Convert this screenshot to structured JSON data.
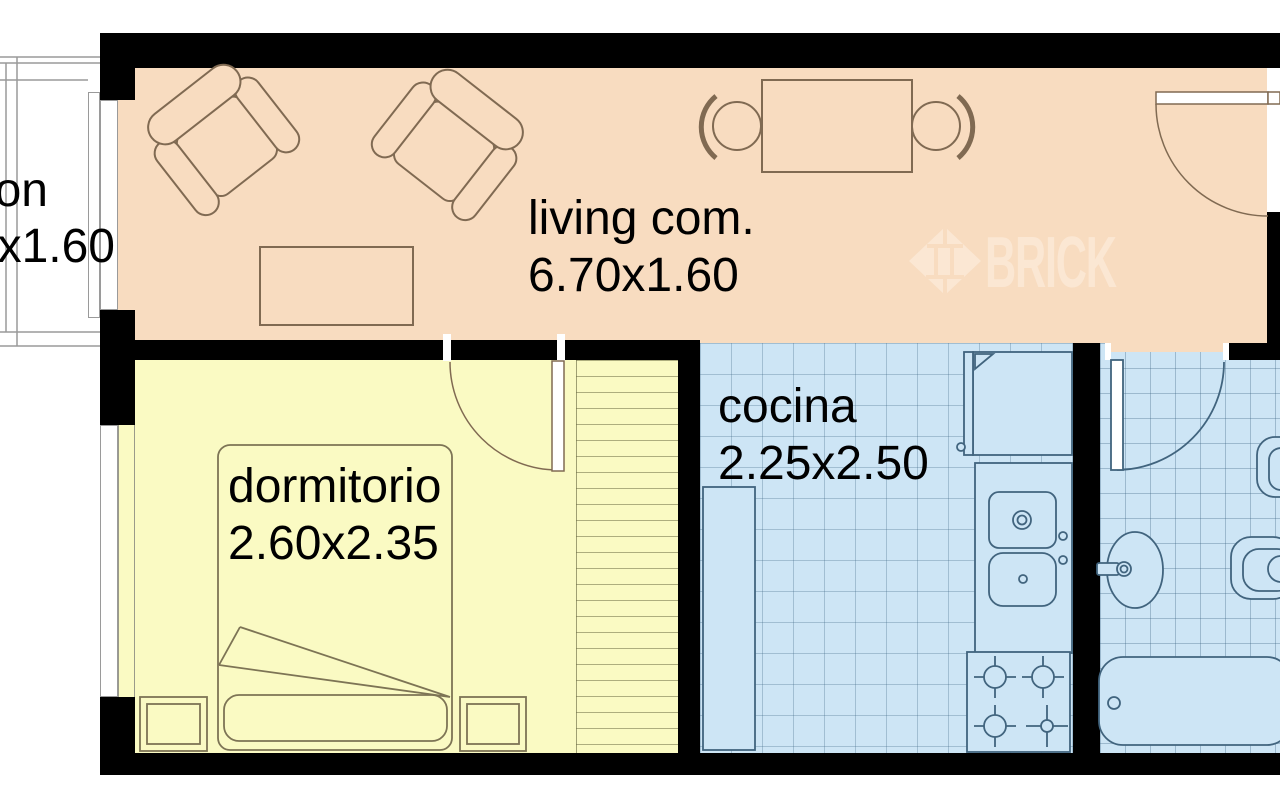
{
  "watermark": {
    "brand": "BRICK"
  },
  "rooms": {
    "living": {
      "name": "living com.",
      "dims": "6.70x1.60"
    },
    "bedroom": {
      "name": "dormitorio",
      "dims": "2.60x2.35"
    },
    "kitchen": {
      "name": "cocina",
      "dims": "2.25x2.50"
    },
    "balcony": {
      "name_fragment": "on",
      "dims_fragment": "x1.60"
    }
  },
  "colors": {
    "living": "#f8dcc0",
    "bedroom": "#fafac3",
    "wet": "#cde5f5",
    "wall": "#000000",
    "watermark": "#fbe7d3",
    "outline_warm": "#806a52",
    "outline_bed": "#7d7455",
    "outline_cool": "#41647e",
    "balcony_line": "#9a9a9a"
  }
}
